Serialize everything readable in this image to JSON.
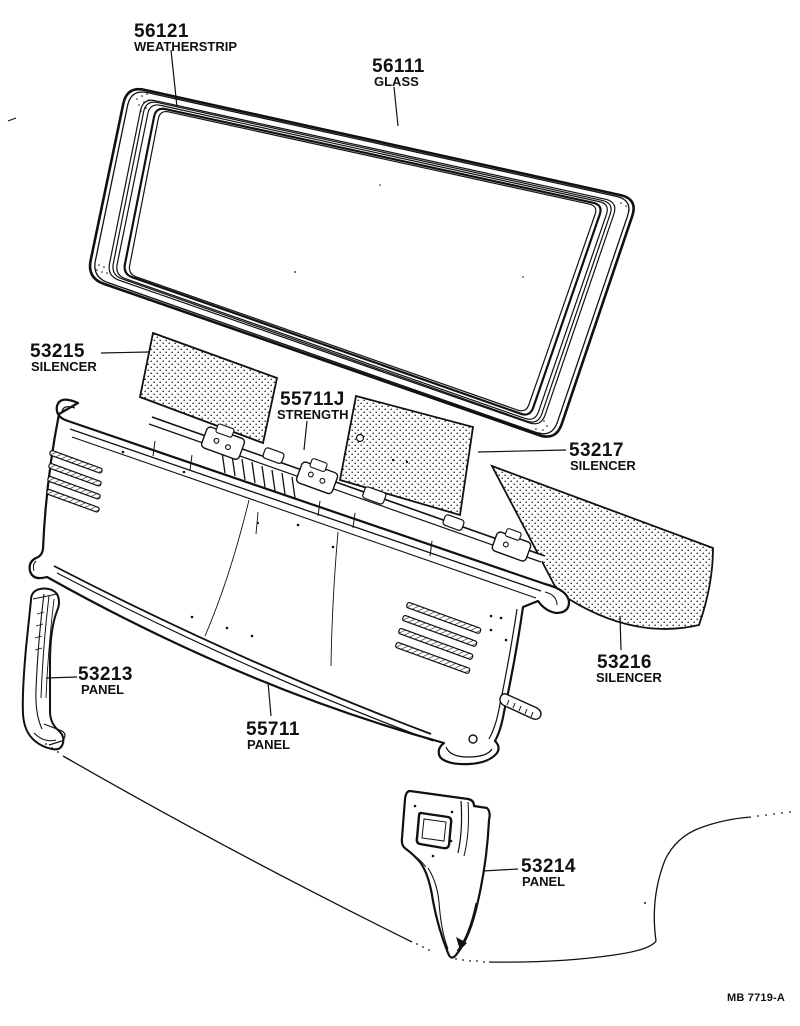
{
  "diagram": {
    "drawing_code": "MB 7719-A",
    "ink_color": "#111111",
    "paper_color": "#ffffff",
    "parts": [
      {
        "number": "56121",
        "name": "WEATHERSTRIP"
      },
      {
        "number": "56111",
        "name": "GLASS"
      },
      {
        "number": "53215",
        "name": "SILENCER"
      },
      {
        "number": "55711J",
        "name": "STRENGTH"
      },
      {
        "number": "53217",
        "name": "SILENCER"
      },
      {
        "number": "53216",
        "name": "SILENCER"
      },
      {
        "number": "53213",
        "name": "PANEL"
      },
      {
        "number": "55711",
        "name": "PANEL"
      },
      {
        "number": "53214",
        "name": "PANEL"
      }
    ]
  }
}
